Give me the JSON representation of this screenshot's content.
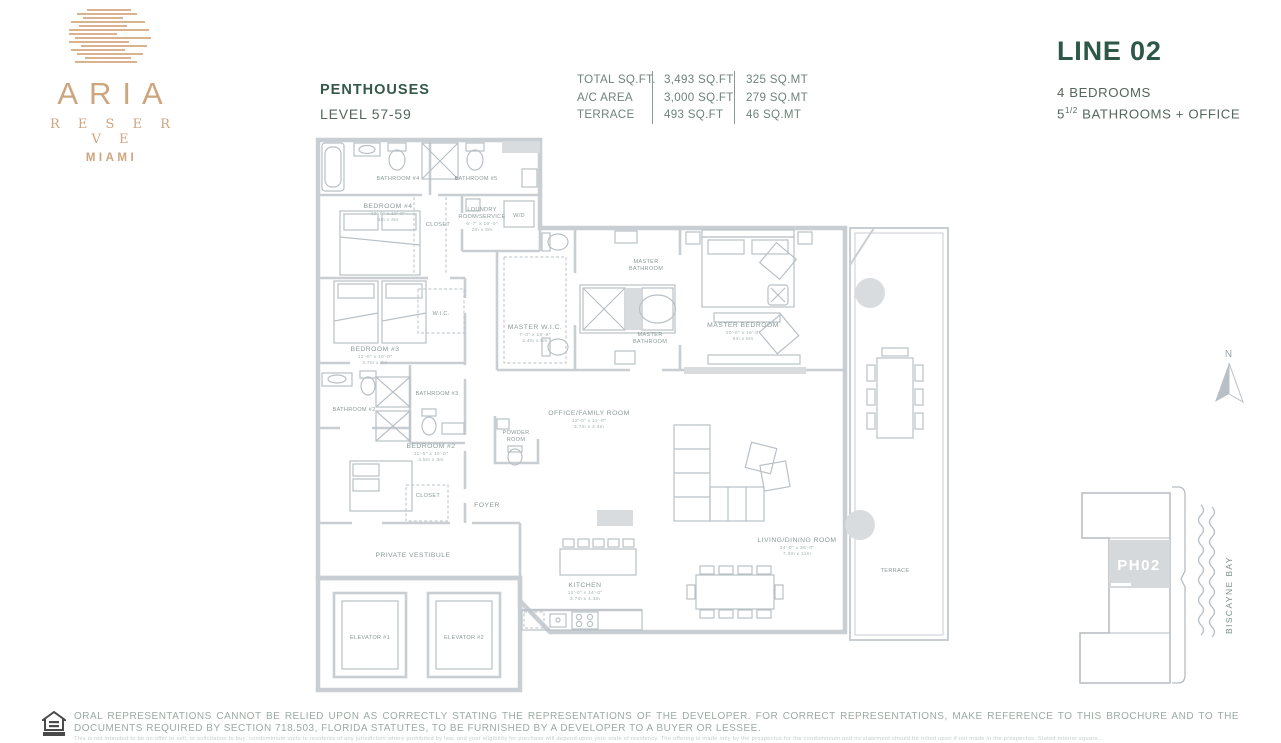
{
  "brand": {
    "name": "ARIA",
    "sub": "R E S E R V E",
    "city": "MIAMI"
  },
  "header": {
    "category": "PENTHOUSES",
    "level": "LEVEL 57-59"
  },
  "stats": {
    "rows": [
      {
        "label": "TOTAL SQ.FT.",
        "sqft": "3,493 SQ.FT",
        "sqmt": "325 SQ.MT"
      },
      {
        "label": "A/C AREA",
        "sqft": "3,000 SQ.FT",
        "sqmt": "279 SQ.MT"
      },
      {
        "label": "TERRACE",
        "sqft": "493 SQ.FT",
        "sqmt": "46 SQ.MT"
      }
    ]
  },
  "unit": {
    "line": "LINE 02",
    "bedrooms": "4 BEDROOMS",
    "bath_base": "5",
    "bath_sup": "1/2",
    "bath_rest": " BATHROOMS + OFFICE"
  },
  "floorplan": {
    "compass_n": "N",
    "rooms": [
      {
        "name": "BATHROOM #4"
      },
      {
        "name": "BATHROOM #5"
      },
      {
        "name": "BEDROOM #4",
        "ft": "10'-0\" x 10'-0\"",
        "m": "3m x 3m"
      },
      {
        "name": "CLOSET"
      },
      {
        "name": "LOUNDRY",
        "name2": "ROOM/SERVICE",
        "ft": "6'-7\" x 10'-0\"",
        "m": "2m x 3m"
      },
      {
        "name": "W/D"
      },
      {
        "name": "BEDROOM #3",
        "ft": "12'-0\" x 10'-0\"",
        "m": "3.7m x 3m"
      },
      {
        "name": "W.I.C."
      },
      {
        "name": "BATHROOM #3"
      },
      {
        "name": "BATHROOM #2"
      },
      {
        "name": "BEDROOM #2",
        "ft": "11'-5\" x 10'-0\"",
        "m": "3.5m x 3m"
      },
      {
        "name": "CLOSET"
      },
      {
        "name": "FOYER"
      },
      {
        "name": "POWDER",
        "name2": "ROOM"
      },
      {
        "name": "OFFICE/FAMILY ROOM",
        "ft": "12'-0\" x 11'-0\"",
        "m": "3.7m x 3.4m"
      },
      {
        "name": "MASTER W.I.C.",
        "ft": "7'-0\" x 16'-8\"",
        "m": "2.4m x 5m"
      },
      {
        "name": "MASTER",
        "name2": "BATHROOM"
      },
      {
        "name": "MASTER",
        "name2": "BATHROOM"
      },
      {
        "name": "MASTER BEDROOM",
        "ft": "20'-0\" x 16'-8\"",
        "m": "6m x 5m"
      },
      {
        "name": "KITCHEN",
        "ft": "12'-0\" x 14'-0\"",
        "m": "3.7m x 4.3m"
      },
      {
        "name": "LIVING/DINING ROOM",
        "ft": "24'-0\" x 36'-0\"",
        "m": "7.3m x 11m"
      },
      {
        "name": "TERRACE"
      },
      {
        "name": "PRIVATE VESTIBULE"
      },
      {
        "name": "ELEVATOR #1"
      },
      {
        "name": "ELEVATOR #2"
      }
    ]
  },
  "keyplan": {
    "unit_label": "PH02",
    "water_label": "BISCAYNE BAY"
  },
  "footer": {
    "line1": "ORAL REPRESENTATIONS CANNOT BE RELIED UPON AS CORRECTLY STATING THE REPRESENTATIONS OF THE DEVELOPER. FOR CORRECT REPRESENTATIONS, MAKE REFERENCE TO THIS BROCHURE AND TO THE DOCUMENTS REQUIRED BY SECTION 718.503, FLORIDA STATUTES, TO BE FURNISHED BY A DEVELOPER TO A BUYER OR LESSEE.",
    "line2": "This is not intended to be an offer to sell, or solicitation to buy, condominium units to residents of any jurisdiction where prohibited by law, and your eligibility for purchase will depend upon your state of residency. The offering is made only by the prospectus for the condominium and no statement should be relied upon if not made in the prospectus. Stated interior square..."
  },
  "colors": {
    "gold": "#cda57e",
    "green_dark": "#2d5847",
    "green_text": "#54675d",
    "plan_gray": "#c9ced3",
    "label_teal": "#8b9a99"
  }
}
